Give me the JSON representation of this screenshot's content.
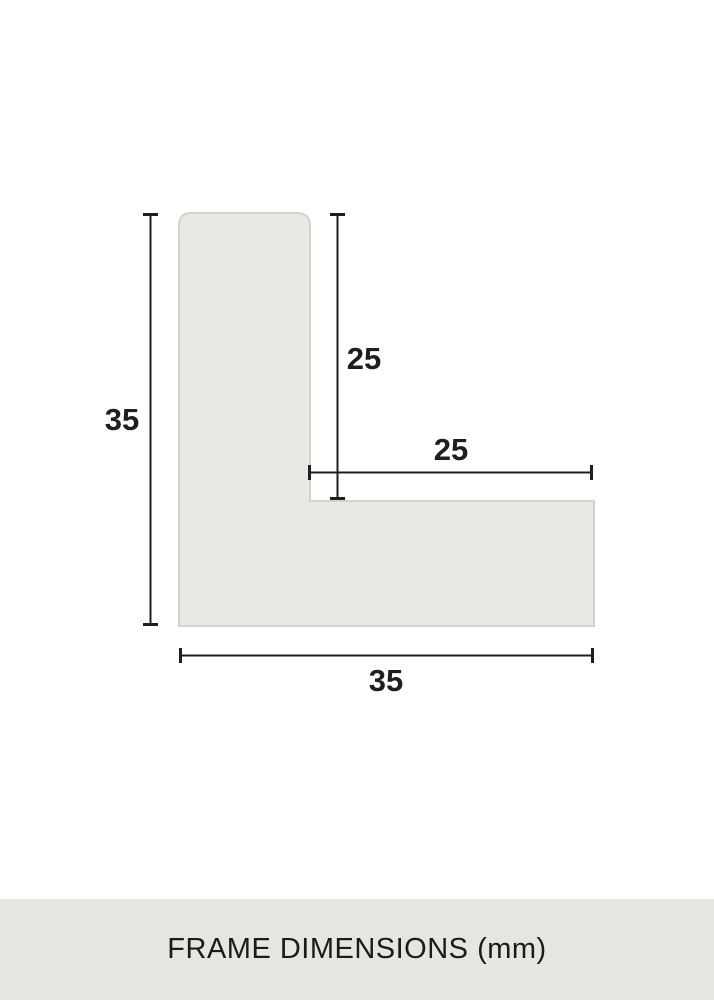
{
  "page": {
    "caption": "FRAME DIMENSIONS (mm)",
    "unit": "mm"
  },
  "dimensions": {
    "outer_height": {
      "label": "35",
      "value": 35,
      "orientation": "vertical",
      "side": "left"
    },
    "inner_height": {
      "label": "25",
      "value": 25,
      "orientation": "vertical",
      "side": "inner"
    },
    "inner_width": {
      "label": "25",
      "value": 25,
      "orientation": "horizontal",
      "side": "inner"
    },
    "outer_width": {
      "label": "35",
      "value": 35,
      "orientation": "horizontal",
      "side": "bottom"
    }
  },
  "colors": {
    "background": "#ffffff",
    "profile_fill": "#e9e8e3",
    "profile_border": "#d3d2cd",
    "dimension_line": "#1f1f1f",
    "caption_band_background": "#e6e5e0",
    "text": "#1f1f1f"
  }
}
